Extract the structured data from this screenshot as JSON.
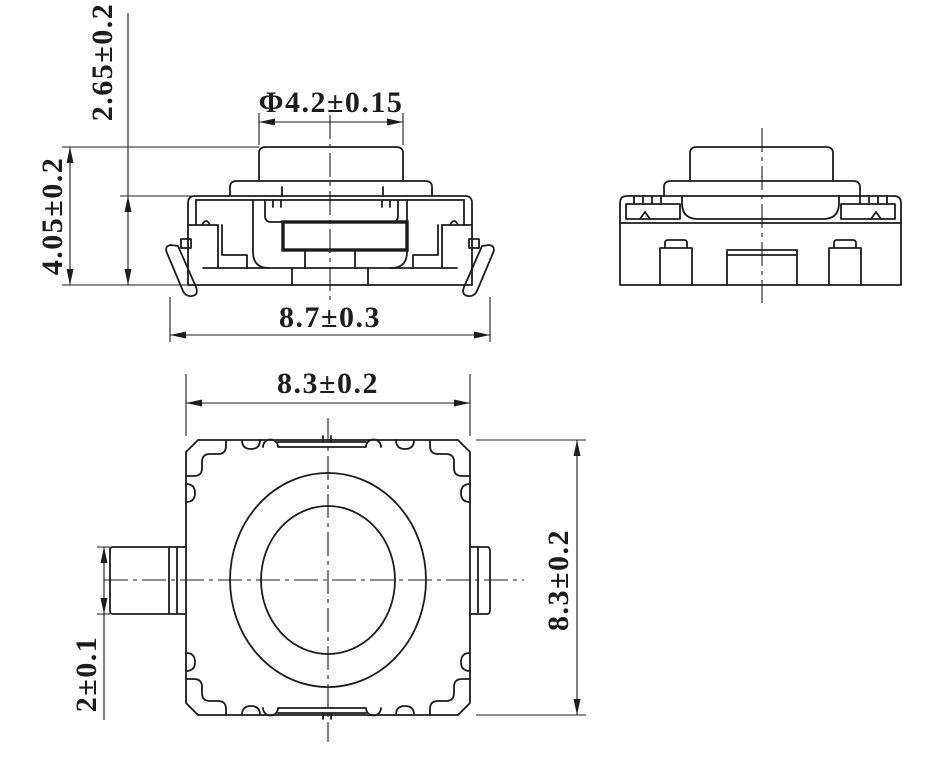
{
  "drawing": {
    "background_color": "#ffffff",
    "line_color": "#1c1c1c",
    "views": {
      "front": {
        "dimensions": {
          "body_height": "2.65±0.2",
          "total_height": "4.05±0.2",
          "button_diameter": "Φ4.2±0.15",
          "overall_width": "8.7±0.3"
        }
      },
      "side": {
        "dimensions": {}
      },
      "top": {
        "dimensions": {
          "body_width": "8.3±0.2",
          "body_depth": "8.3±0.2",
          "terminal_width": "2±0.1"
        }
      }
    }
  }
}
